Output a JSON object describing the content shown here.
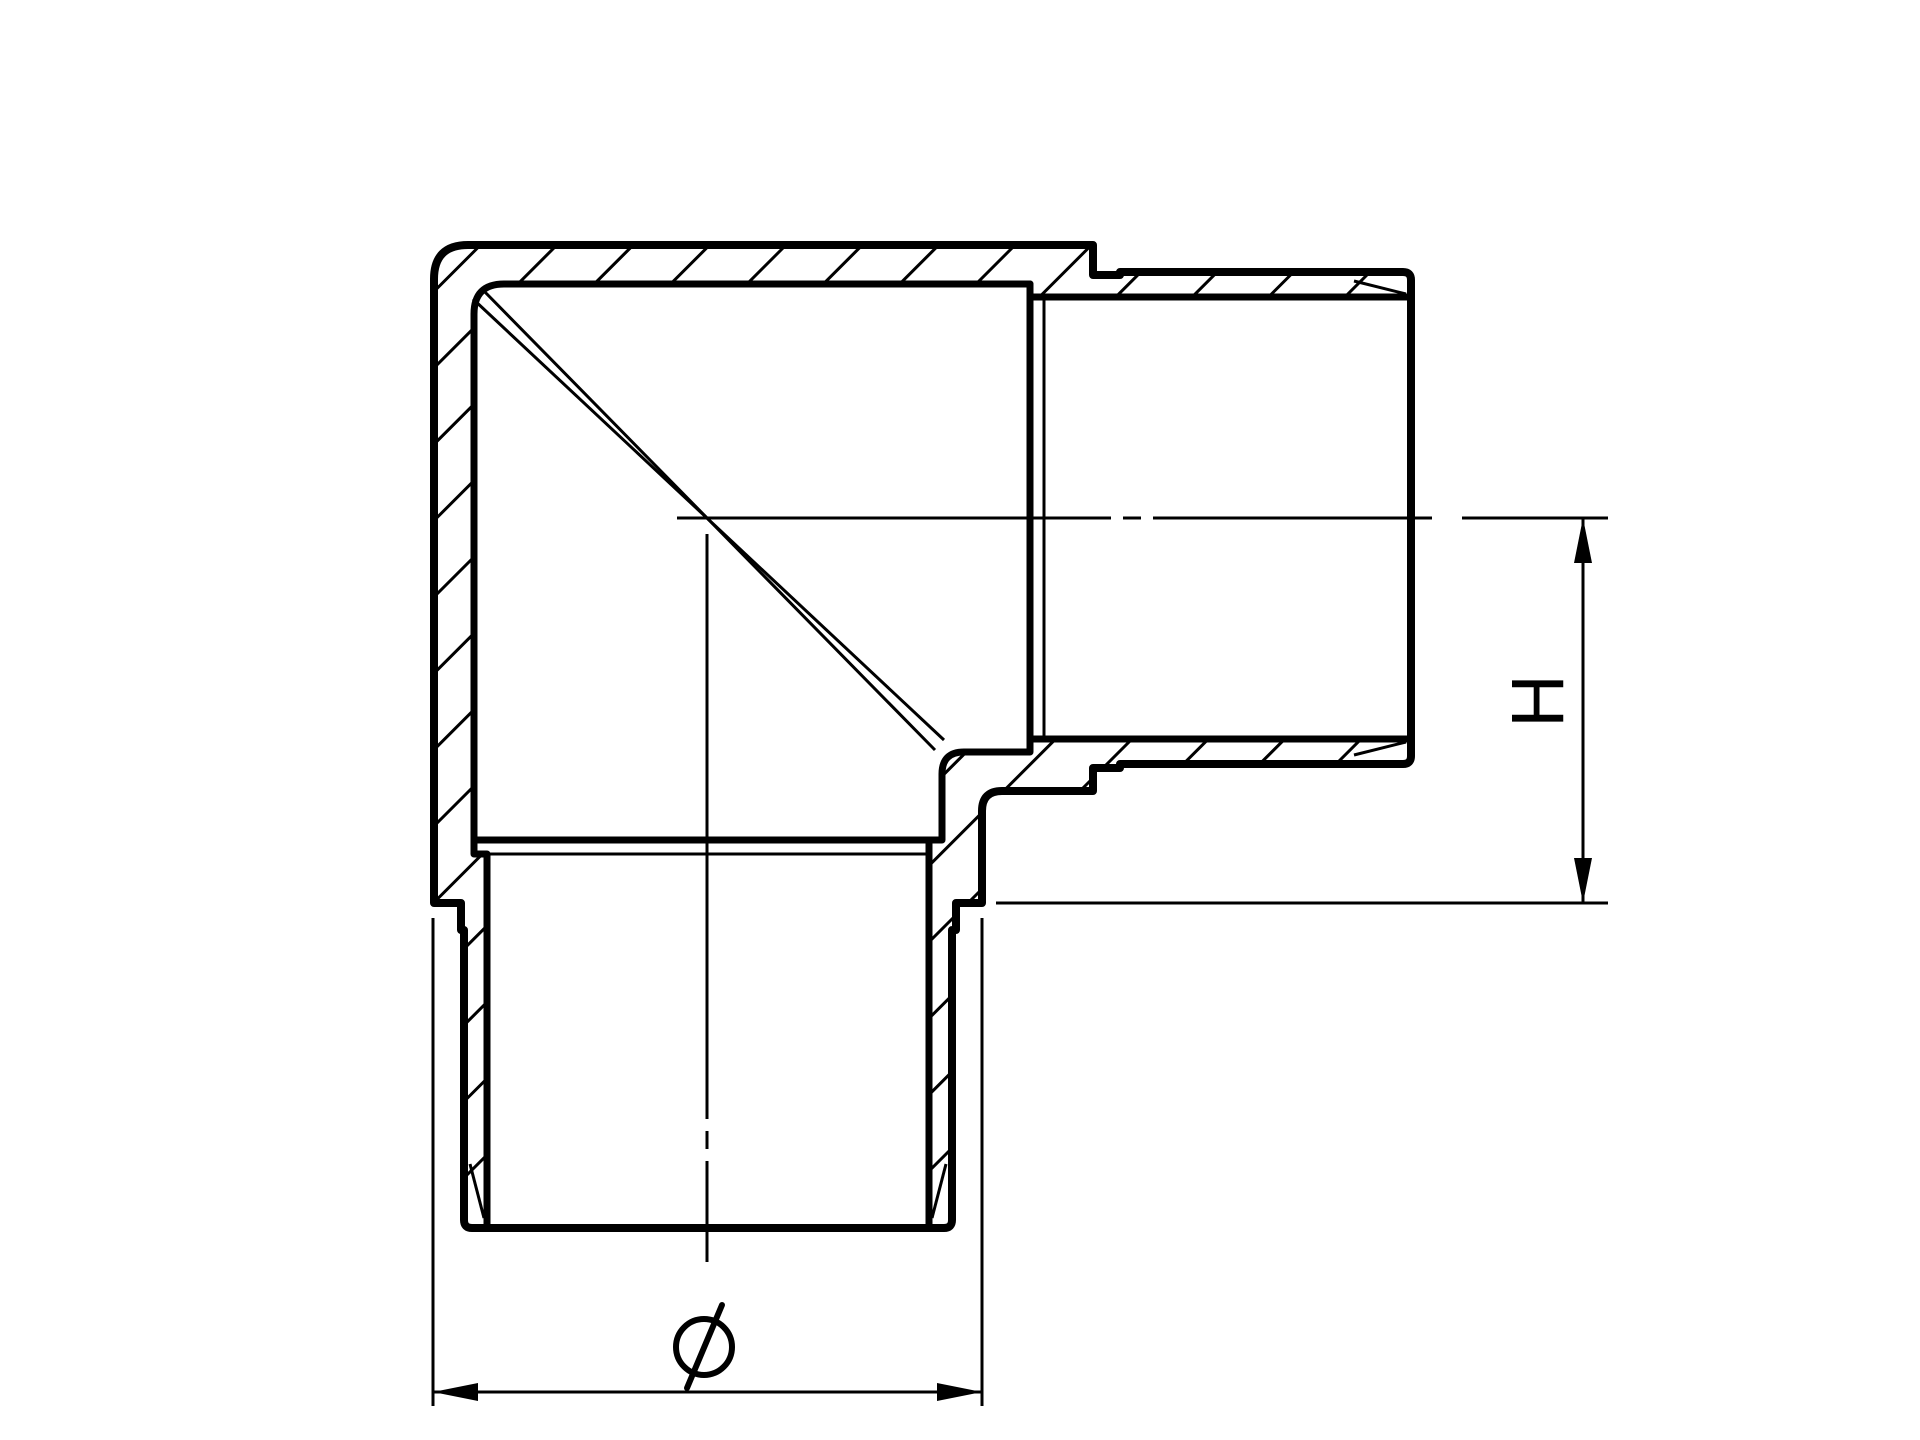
{
  "drawing": {
    "description": "Cross-section technical drawing of a 90-degree corner elbow tube fitting with two male spigot ends, section hatching, centerlines and dimension callouts",
    "background_color": "#ffffff",
    "line_color": "#000000",
    "dimensions": {
      "height_label": "H",
      "diameter_label": "⌀"
    }
  }
}
